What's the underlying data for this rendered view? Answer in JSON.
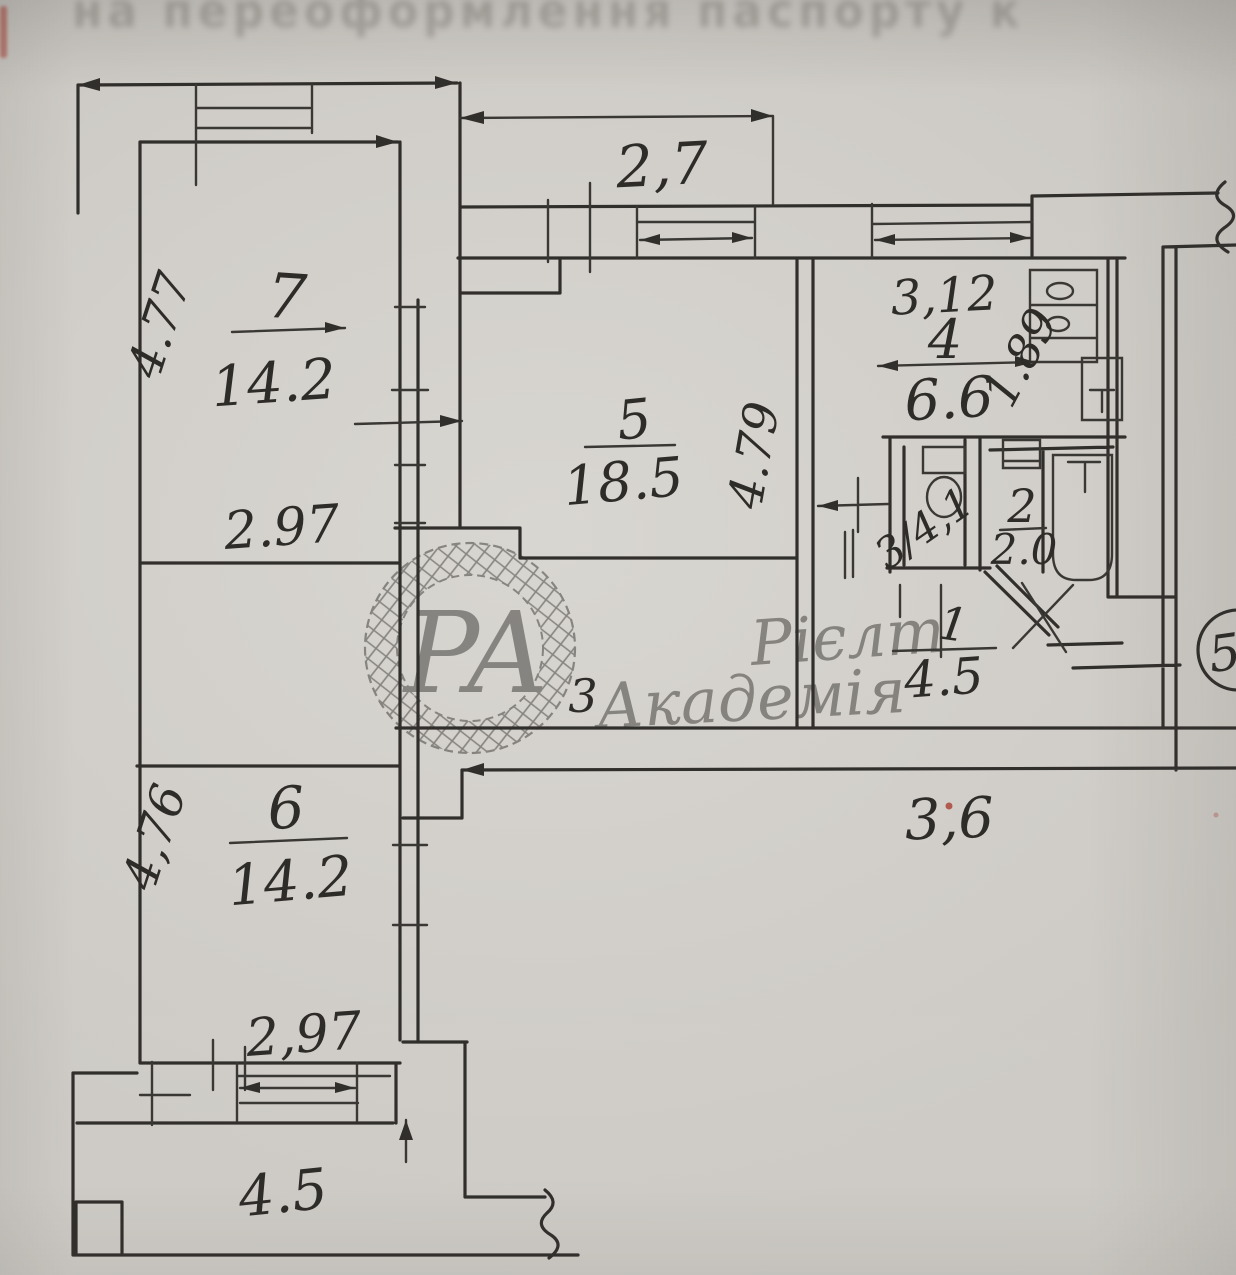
{
  "page": {
    "ghost_text": "на переоформлення паспорту к"
  },
  "watermark": {
    "monogram": "РА",
    "line1": "Рієлт",
    "line2": "Академія"
  },
  "stamp": {
    "number": "5"
  },
  "plan": {
    "balcony_top": {
      "width": "2,7"
    },
    "room7": {
      "number": "7",
      "area": "14.2",
      "width": "2.97",
      "height": "4.77"
    },
    "room6": {
      "number": "6",
      "area": "14.2",
      "width": "2,97",
      "height": "4,76"
    },
    "room5": {
      "number": "5",
      "area": "18.5",
      "depth": "4.79"
    },
    "kitchen": {
      "number": "4",
      "area": "6.6",
      "width": "3,12",
      "depth": "1.89"
    },
    "toilet": {
      "label": "3/4,1"
    },
    "wc": {
      "number": "2",
      "area": "2.0"
    },
    "hall": {
      "number": "1",
      "area": "4.5"
    },
    "corridor": {
      "width": "3,6"
    },
    "loggia": {
      "area": "4.5"
    },
    "door_mark": "3"
  },
  "colors": {
    "ink": "#312f2c",
    "paper": "#cdcac5",
    "watermark_ink": "#3c3a37",
    "red_mark": "#a63326"
  }
}
